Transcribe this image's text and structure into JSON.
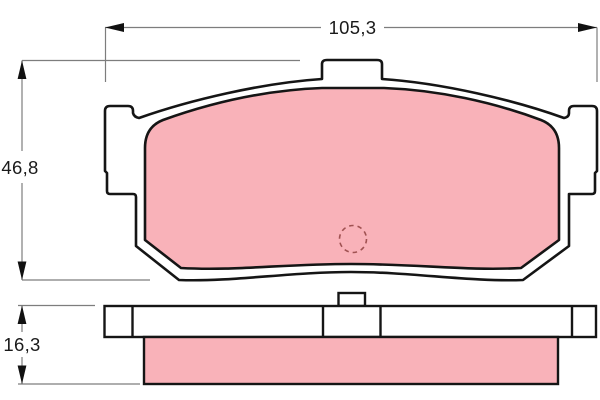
{
  "drawing": {
    "kind": "brake-pad-dimension-drawing",
    "dimensions": {
      "width_label": "105,3",
      "height_label": "46,8",
      "thickness_label": "16,3"
    },
    "colors": {
      "background": "#ffffff",
      "outline": "#151515",
      "plate_fill": "#ffffff",
      "friction_material": "#f9b2b9",
      "dimension_line": "#7d7d7d",
      "arrowhead": "#111111",
      "label_text": "#1a1a1a",
      "hole_marker": "#a05252"
    }
  }
}
